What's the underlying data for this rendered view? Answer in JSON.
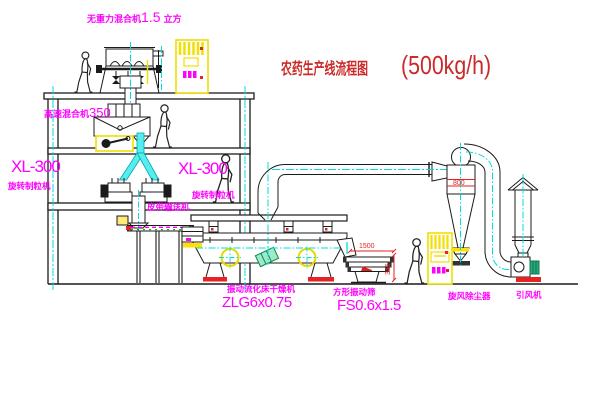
{
  "title": {
    "text": "农药生产线流程图",
    "capacity": "(500kg/h)"
  },
  "equipment_labels": {
    "gravity_mixer": {
      "name": "无重力混合机",
      "value": "1.5",
      "unit": "立方"
    },
    "high_speed_mixer": {
      "name": "高速混合机",
      "value": "350"
    },
    "granulator_left": {
      "model": "XL-300",
      "name": "旋转制粒机"
    },
    "granulator_center": {
      "model": "XL-300",
      "name": "旋转制粒机"
    },
    "belt_conveyor": {
      "name": "皮带输送机"
    },
    "fluid_bed_dryer": {
      "name": "振动流化床干燥机",
      "model": "ZLG6x0.75"
    },
    "vibrating_screen": {
      "name": "方形振动筛",
      "model": "FS0.6x1.5"
    },
    "cyclone": {
      "name": "旋风除尘器"
    },
    "fan": {
      "name": "引风机"
    }
  },
  "dimensions": {
    "cyclone_width": "800",
    "screen_length": "1500",
    "screen_height": "345"
  },
  "colors": {
    "label_magenta": "#ff00ff",
    "title_red": "#cc2a2a",
    "dimension_red": "#e62222",
    "centerline_cyan": "#00dcdc",
    "pipe_fill_cyan": "#55eded",
    "cabinet_yellow": "#f0df00",
    "motor_green": "#18a878",
    "line_black": "#1b1b1b"
  }
}
